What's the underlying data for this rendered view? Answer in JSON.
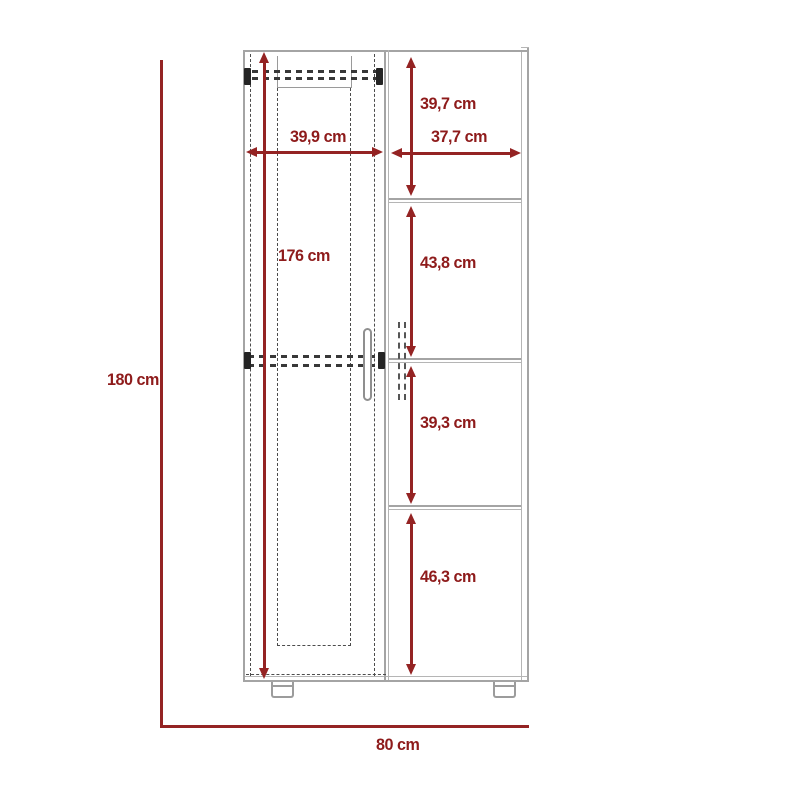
{
  "diagram": {
    "kind": "furniture dimension drawing",
    "unit": "cm",
    "dimension_color": "#942323",
    "outline_color": "#a4a4a4",
    "hidden_line_color": "#4c4c4c",
    "dimensions": {
      "overall_height": {
        "label": "180 cm"
      },
      "interior_height": {
        "label": "176 cm"
      },
      "left_section_width": {
        "label": "39,9 cm"
      },
      "right_section_width": {
        "label": "37,7 cm"
      },
      "right_shelf_1_height": {
        "label": "39,7 cm"
      },
      "right_shelf_2_height": {
        "label": "43,8 cm"
      },
      "right_shelf_3_height": {
        "label": "39,3 cm"
      },
      "right_shelf_4_height": {
        "label": "46,3 cm"
      },
      "overall_width": {
        "label": "80 cm"
      }
    }
  }
}
